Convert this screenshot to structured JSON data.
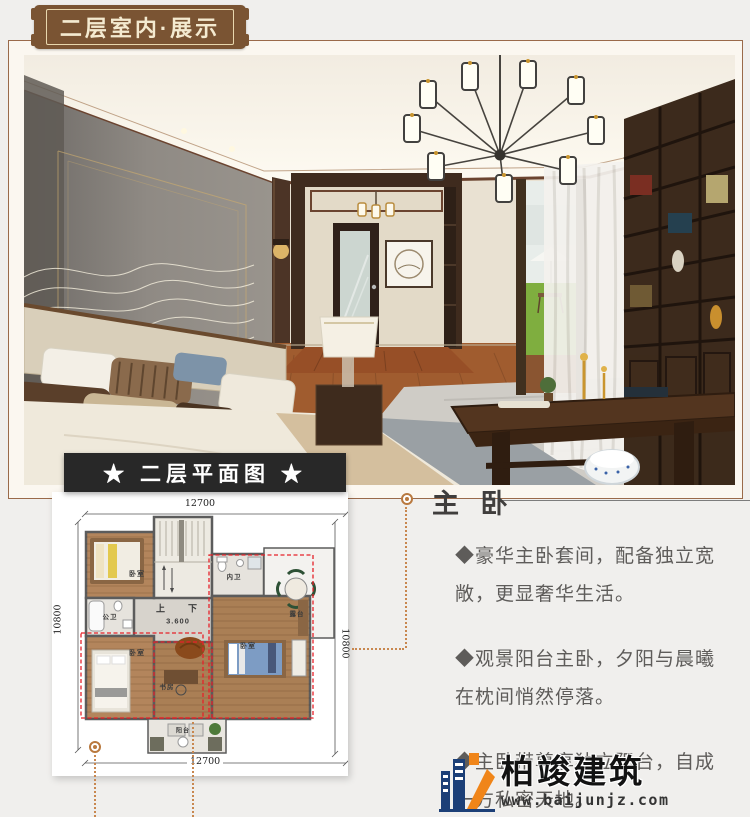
{
  "badge": {
    "label": "二层室内·展示",
    "bg": "#7a5433",
    "text_color": "#f4ead0"
  },
  "plan": {
    "banner": "★ 二层平面图 ★",
    "dim_top": "12700",
    "dim_bottom": "12700",
    "dim_left": "10800",
    "dim_right": "10800",
    "labels": [
      {
        "t": "卧室",
        "x": 85,
        "y": 82,
        "s": 7
      },
      {
        "t": "内卫",
        "x": 182,
        "y": 84,
        "s": 6.5
      },
      {
        "t": "露台",
        "x": 245,
        "y": 121,
        "s": 6.5
      },
      {
        "t": "公卫",
        "x": 58,
        "y": 124,
        "s": 6.5
      },
      {
        "t": "卧室",
        "x": 85,
        "y": 161,
        "s": 7
      },
      {
        "t": "书房",
        "x": 115,
        "y": 194,
        "s": 6.5
      },
      {
        "t": "卧室",
        "x": 196,
        "y": 154,
        "s": 7
      },
      {
        "t": "阳台",
        "x": 131,
        "y": 238,
        "s": 6
      },
      {
        "t": "上",
        "x": 109,
        "y": 116,
        "s": 9
      },
      {
        "t": "下",
        "x": 141,
        "y": 116,
        "s": 9
      },
      {
        "t": "3.600",
        "x": 126,
        "y": 129,
        "s": 7.5
      }
    ]
  },
  "description": {
    "title": "主 卧",
    "bullets": [
      "◆豪华主卧套间，配备独立宽敞，更显奢华生活。",
      "◆观景阳台主卧，夕阳与晨曦在枕间悄然停落。",
      "◆主卧带尊享独立阳台，自成一方私密天地。"
    ]
  },
  "logo": {
    "name": "柏竣建筑",
    "url": "www.baijunjz.com",
    "blue": "#1c3f77",
    "orange": "#f08519"
  },
  "colors": {
    "accent_brown": "#9a6a4a",
    "connector_orange": "#c8874f",
    "highlight_red": "#e62129",
    "banner_black": "#282828"
  }
}
